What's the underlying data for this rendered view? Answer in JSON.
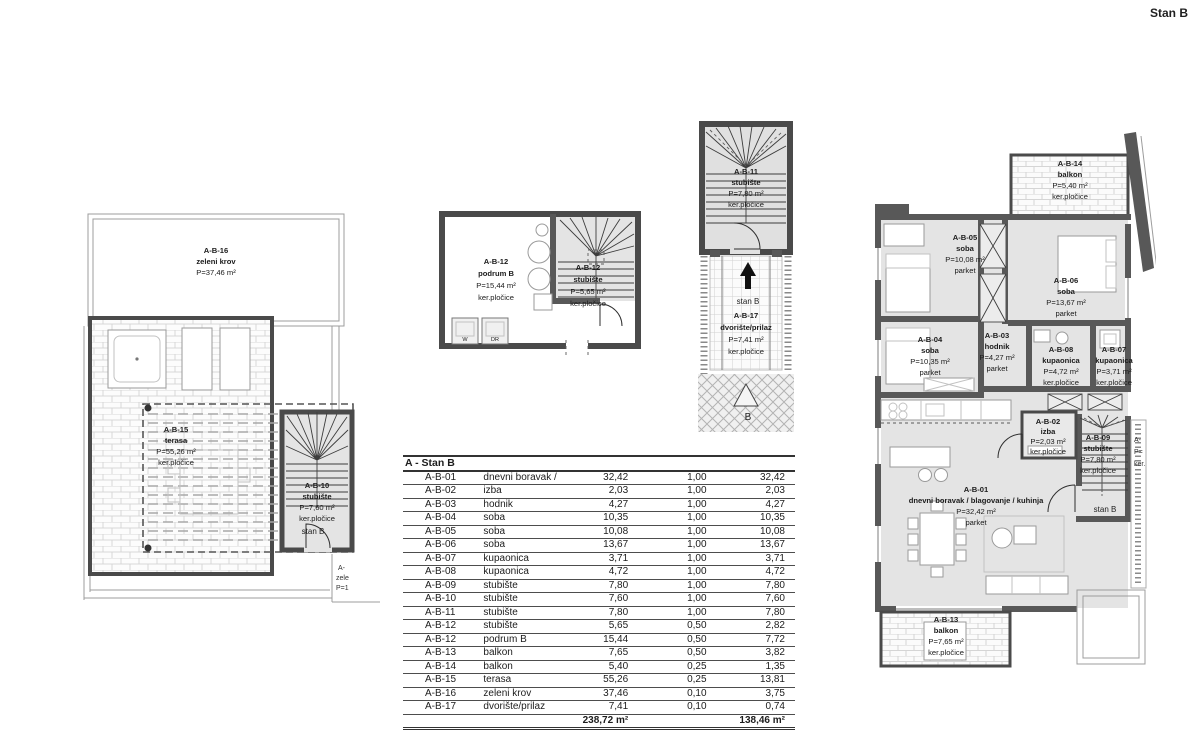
{
  "title": "Stan B",
  "rooms": {
    "r01": {
      "id": "A-B-01",
      "name": "dnevni boravak / blagovanje / kuhinja",
      "area": "P=32,42 m²",
      "floor": "parket"
    },
    "r02": {
      "id": "A-B-02",
      "name": "izba",
      "area": "P=2,03 m²",
      "floor": "ker.pločice"
    },
    "r03": {
      "id": "A-B-03",
      "name": "hodnik",
      "area": "P=4,27 m²",
      "floor": "parket"
    },
    "r04": {
      "id": "A-B-04",
      "name": "soba",
      "area": "P=10,35 m²",
      "floor": "parket"
    },
    "r05": {
      "id": "A-B-05",
      "name": "soba",
      "area": "P=10,08 m²",
      "floor": "parket"
    },
    "r06": {
      "id": "A-B-06",
      "name": "soba",
      "area": "P=13,67 m²",
      "floor": "parket"
    },
    "r07": {
      "id": "A-B-07",
      "name": "kupaonica",
      "area": "P=3,71 m²",
      "floor": "ker.pločice"
    },
    "r08": {
      "id": "A-B-08",
      "name": "kupaonica",
      "area": "P=4,72 m²",
      "floor": "ker.pločice"
    },
    "r09": {
      "id": "A-B-09",
      "name": "stubište",
      "area": "P=7,80 m²",
      "floor": "ker.pločice"
    },
    "r10": {
      "id": "A-B-10",
      "name": "stubište",
      "area": "P=7,60 m²",
      "floor": "ker.pločice"
    },
    "r11": {
      "id": "A-B-11",
      "name": "stubište",
      "area": "P=7,80 m²",
      "floor": "ker.pločice"
    },
    "r12s": {
      "id": "A-B-12",
      "name": "stubište",
      "area": "P=5,65 m²",
      "floor": "ker.pločice"
    },
    "r12p": {
      "id": "A-B-12",
      "name": "podrum B",
      "area": "P=15,44 m²",
      "floor": "ker.pločice"
    },
    "r13": {
      "id": "A-B-13",
      "name": "balkon",
      "area": "P=7,65 m²",
      "floor": "ker.pločice"
    },
    "r14": {
      "id": "A-B-14",
      "name": "balkon",
      "area": "P=5,40 m²",
      "floor": "ker.pločice"
    },
    "r15": {
      "id": "A-B-15",
      "name": "terasa",
      "area": "P=55,26 m²",
      "floor": "ker.pločice"
    },
    "r16": {
      "id": "A-B-16",
      "name": "zeleni krov",
      "area": "P=37,46 m²"
    },
    "r17": {
      "id": "A-B-17",
      "name": "dvorište/prilaz",
      "area": "P=7,41 m²",
      "floor": "ker.pločice"
    }
  },
  "markers": {
    "stan_b": "stan B",
    "b": "B",
    "w": "W",
    "dr": "DR"
  },
  "cropped": {
    "left_1": "A-",
    "left_2": "zele",
    "left_3": "P=1",
    "right_1": "A-",
    "right_2": "P=",
    "right_3": "ker."
  },
  "table": {
    "header": "A - Stan B",
    "rows": [
      [
        "A-B-01",
        "dnevni boravak / blagovanje / kuhinja",
        "32,42",
        "1,00",
        "32,42"
      ],
      [
        "A-B-02",
        "izba",
        "2,03",
        "1,00",
        "2,03"
      ],
      [
        "A-B-03",
        "hodnik",
        "4,27",
        "1,00",
        "4,27"
      ],
      [
        "A-B-04",
        "soba",
        "10,35",
        "1,00",
        "10,35"
      ],
      [
        "A-B-05",
        "soba",
        "10,08",
        "1,00",
        "10,08"
      ],
      [
        "A-B-06",
        "soba",
        "13,67",
        "1,00",
        "13,67"
      ],
      [
        "A-B-07",
        "kupaonica",
        "3,71",
        "1,00",
        "3,71"
      ],
      [
        "A-B-08",
        "kupaonica",
        "4,72",
        "1,00",
        "4,72"
      ],
      [
        "A-B-09",
        "stubište",
        "7,80",
        "1,00",
        "7,80"
      ],
      [
        "A-B-10",
        "stubište",
        "7,60",
        "1,00",
        "7,60"
      ],
      [
        "A-B-11",
        "stubište",
        "7,80",
        "1,00",
        "7,80"
      ],
      [
        "A-B-12",
        "stubište",
        "5,65",
        "0,50",
        "2,82"
      ],
      [
        "A-B-12",
        "podrum B",
        "15,44",
        "0,50",
        "7,72"
      ],
      [
        "A-B-13",
        "balkon",
        "7,65",
        "0,50",
        "3,82"
      ],
      [
        "A-B-14",
        "balkon",
        "5,40",
        "0,25",
        "1,35"
      ],
      [
        "A-B-15",
        "terasa",
        "55,26",
        "0,25",
        "13,81"
      ],
      [
        "A-B-16",
        "zeleni krov",
        "37,46",
        "0,10",
        "3,75"
      ],
      [
        "A-B-17",
        "dvorište/prilaz",
        "7,41",
        "0,10",
        "0,74"
      ]
    ],
    "total_area": "238,72 m²",
    "total_reduced": "138,46 m²"
  }
}
